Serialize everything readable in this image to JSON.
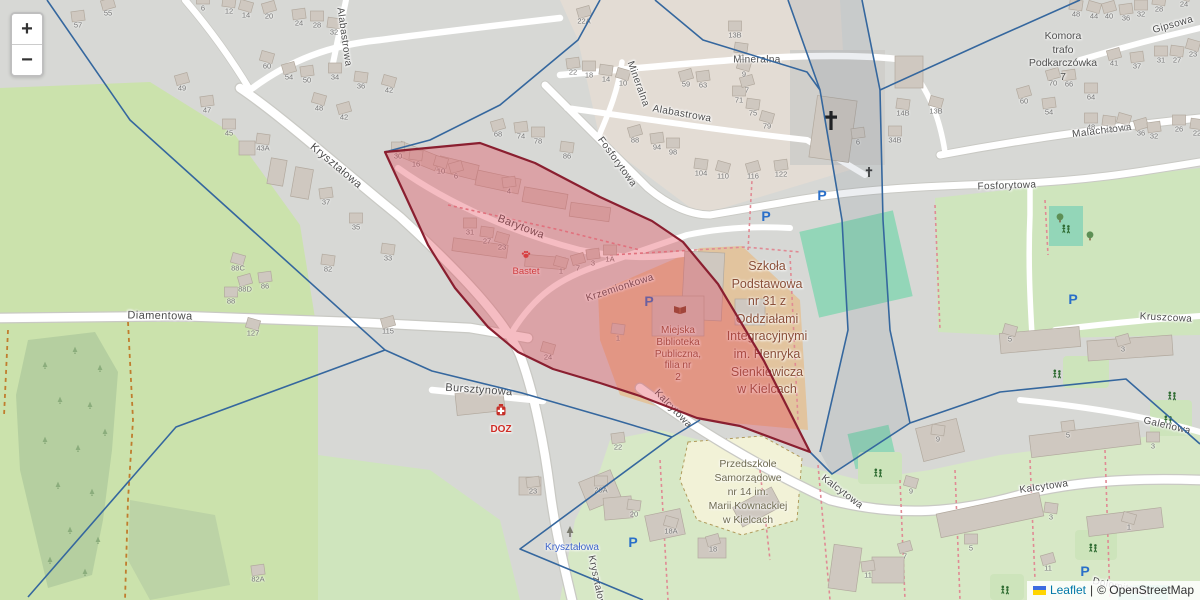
{
  "map": {
    "controls": {
      "zoom_in": "+",
      "zoom_out": "−"
    },
    "attribution": {
      "leaflet": "Leaflet",
      "separator": "|",
      "copyright": "© OpenStreetMap"
    },
    "colors": {
      "selection_fill": "rgba(228,70,86,0.36)",
      "selection_stroke": "#8a1f30",
      "overlay_line": "#35679e",
      "parking_blue": "#2a6fc9",
      "poi_red": "#cc3b35",
      "bus_stop_blue": "#3c63c9",
      "school_label_brown": "#8a4f38"
    }
  },
  "labels": {
    "streets": [
      {
        "text": "Kryształowa",
        "x": 336,
        "y": 166,
        "rot": 40,
        "size": 11
      },
      {
        "text": "Diamentowa",
        "x": 160,
        "y": 316,
        "rot": 1,
        "size": 11
      },
      {
        "text": "Bursztynowa",
        "x": 479,
        "y": 390,
        "rot": 4,
        "size": 11
      },
      {
        "text": "Barytowa",
        "x": 521,
        "y": 227,
        "rot": 21,
        "size": 11
      },
      {
        "text": "Krzemionkowa",
        "x": 620,
        "y": 288,
        "rot": -18,
        "size": 10
      },
      {
        "text": "Kalcytowa",
        "x": 673,
        "y": 409,
        "rot": 46,
        "size": 10
      },
      {
        "text": "Kalcytowa",
        "x": 842,
        "y": 492,
        "rot": 37,
        "size": 10
      },
      {
        "text": "Kalcytowa",
        "x": 1044,
        "y": 487,
        "rot": -8,
        "size": 10
      },
      {
        "text": "Fosforytowa",
        "x": 617,
        "y": 162,
        "rot": 54,
        "size": 10
      },
      {
        "text": "Fosforytowa",
        "x": 1007,
        "y": 186,
        "rot": -2,
        "size": 10
      },
      {
        "text": "Alabastrowa",
        "x": 344,
        "y": 37,
        "rot": 82,
        "size": 10
      },
      {
        "text": "Alabastrowa",
        "x": 682,
        "y": 114,
        "rot": 10,
        "size": 10
      },
      {
        "text": "Mineralna",
        "x": 757,
        "y": 60,
        "rot": 0,
        "size": 10
      },
      {
        "text": "Mineralna",
        "x": 638,
        "y": 84,
        "rot": 70,
        "size": 10
      },
      {
        "text": "Malachitowa",
        "x": 1102,
        "y": 131,
        "rot": -7,
        "size": 10
      },
      {
        "text": "Gipsowa",
        "x": 1173,
        "y": 25,
        "rot": -16,
        "size": 10
      },
      {
        "text": "Kruszcowa",
        "x": 1166,
        "y": 318,
        "rot": 3,
        "size": 10
      },
      {
        "text": "Galenowa",
        "x": 1167,
        "y": 426,
        "rot": 13,
        "size": 10
      },
      {
        "text": "Kryształowa",
        "x": 597,
        "y": 584,
        "rot": 78,
        "size": 10
      },
      {
        "text": "Dolomitowa",
        "x": 1120,
        "y": 587,
        "rot": 12,
        "size": 10
      }
    ],
    "places": [
      {
        "name": "school",
        "x": 767,
        "y": 258,
        "lh": 17.6,
        "size": 12.5,
        "color": "#8a4f38",
        "lines": [
          "Szkoła",
          "Podstawowa",
          "nr 31 z",
          "Oddziałami",
          "Integracyjnymi",
          "im. Henryka",
          "Sienkiewicza",
          "w Kielcach"
        ]
      },
      {
        "name": "library",
        "x": 678,
        "y": 325,
        "lh": 11.8,
        "size": 10,
        "color": "#8a4f38",
        "lines": [
          "Miejska",
          "Biblioteka",
          "Publiczna,",
          "filia nr",
          "2"
        ]
      },
      {
        "name": "kindergarten",
        "x": 748,
        "y": 457,
        "lh": 14,
        "size": 10.5,
        "color": "#6f6b51",
        "lines": [
          "Przedszkole",
          "Samorządowe",
          "nr 14 im.",
          "Marii Kownackiej",
          "w Kielcach"
        ]
      },
      {
        "name": "transformer-station",
        "x": 1063,
        "y": 30,
        "lh": 13.5,
        "size": 10.5,
        "color": "#4f4f4f",
        "lines": [
          "Komora",
          "trafo",
          "Podkarczówka",
          "7"
        ]
      },
      {
        "name": "bastet-pet-shop",
        "x": 526,
        "y": 266,
        "lh": 11,
        "size": 9.5,
        "color": "#c43c35",
        "lines": [
          "Bastet"
        ]
      },
      {
        "name": "doz-pharmacy",
        "x": 501,
        "y": 424,
        "lh": 11,
        "size": 10,
        "color": "#cf2b24",
        "bold": true,
        "lines": [
          "DOZ"
        ]
      },
      {
        "name": "bus-stop-krysztalowa",
        "x": 572,
        "y": 542,
        "lh": 11,
        "size": 10,
        "color": "#3c63c9",
        "lines": [
          "Kryształowa"
        ]
      }
    ],
    "house_numbers": [
      [
        "55",
        108,
        13
      ],
      [
        "57",
        78,
        25
      ],
      [
        "6",
        203,
        8
      ],
      [
        "12",
        229,
        11
      ],
      [
        "14",
        246,
        15
      ],
      [
        "20",
        269,
        16
      ],
      [
        "24",
        299,
        23
      ],
      [
        "28",
        317,
        25
      ],
      [
        "32",
        334,
        32
      ],
      [
        "60",
        267,
        66
      ],
      [
        "54",
        289,
        77
      ],
      [
        "50",
        307,
        80
      ],
      [
        "34",
        335,
        77
      ],
      [
        "36",
        361,
        86
      ],
      [
        "42",
        389,
        90
      ],
      [
        "49",
        182,
        88
      ],
      [
        "47",
        207,
        110
      ],
      [
        "45",
        229,
        133
      ],
      [
        "43A",
        263,
        148
      ],
      [
        "48",
        319,
        108
      ],
      [
        "42",
        344,
        117
      ],
      [
        "37",
        326,
        202
      ],
      [
        "35",
        356,
        227
      ],
      [
        "33",
        388,
        258
      ],
      [
        "88C",
        238,
        268
      ],
      [
        "88D",
        245,
        289
      ],
      [
        "86",
        265,
        286
      ],
      [
        "88",
        231,
        301
      ],
      [
        "82",
        328,
        269
      ],
      [
        "127",
        253,
        333
      ],
      [
        "115",
        388,
        331
      ],
      [
        "82A",
        258,
        579
      ],
      [
        "30",
        398,
        156
      ],
      [
        "16",
        416,
        164
      ],
      [
        "10",
        441,
        171
      ],
      [
        "6",
        456,
        176
      ],
      [
        "4",
        509,
        191
      ],
      [
        "31",
        470,
        232
      ],
      [
        "27",
        487,
        241
      ],
      [
        "23",
        502,
        247
      ],
      [
        "68",
        498,
        134
      ],
      [
        "74",
        521,
        136
      ],
      [
        "78",
        538,
        141
      ],
      [
        "86",
        567,
        156
      ],
      [
        "1",
        561,
        271
      ],
      [
        "7",
        578,
        268
      ],
      [
        "3",
        593,
        263
      ],
      [
        "1A",
        610,
        259
      ],
      [
        "1",
        618,
        338
      ],
      [
        "24",
        548,
        357
      ],
      [
        "22A",
        584,
        21
      ],
      [
        "22",
        573,
        72
      ],
      [
        "18",
        589,
        75
      ],
      [
        "14",
        606,
        79
      ],
      [
        "10",
        623,
        83
      ],
      [
        "59",
        686,
        84
      ],
      [
        "63",
        703,
        85
      ],
      [
        "71",
        739,
        100
      ],
      [
        "75",
        753,
        113
      ],
      [
        "79",
        767,
        126
      ],
      [
        "88",
        635,
        140
      ],
      [
        "94",
        657,
        147
      ],
      [
        "98",
        673,
        152
      ],
      [
        "104",
        701,
        173
      ],
      [
        "110",
        723,
        176
      ],
      [
        "116",
        753,
        176
      ],
      [
        "122",
        781,
        174
      ],
      [
        "13B",
        735,
        35
      ],
      [
        "11",
        741,
        57
      ],
      [
        "9",
        744,
        74
      ],
      [
        "7",
        747,
        90
      ],
      [
        "6",
        858,
        142
      ],
      [
        "34B",
        895,
        140
      ],
      [
        "14B",
        903,
        113
      ],
      [
        "13B",
        936,
        111
      ],
      [
        "70",
        1053,
        83
      ],
      [
        "66",
        1069,
        84
      ],
      [
        "64",
        1091,
        97
      ],
      [
        "48",
        1076,
        14
      ],
      [
        "44",
        1094,
        16
      ],
      [
        "40",
        1109,
        16
      ],
      [
        "36",
        1126,
        18
      ],
      [
        "32",
        1141,
        14
      ],
      [
        "28",
        1159,
        9
      ],
      [
        "24",
        1184,
        4
      ],
      [
        "41",
        1114,
        63
      ],
      [
        "37",
        1137,
        66
      ],
      [
        "31",
        1161,
        60
      ],
      [
        "27",
        1177,
        60
      ],
      [
        "23",
        1193,
        54
      ],
      [
        "60",
        1024,
        101
      ],
      [
        "54",
        1049,
        112
      ],
      [
        "48",
        1091,
        127
      ],
      [
        "44",
        1109,
        130
      ],
      [
        "40",
        1124,
        128
      ],
      [
        "36",
        1141,
        133
      ],
      [
        "32",
        1154,
        136
      ],
      [
        "26",
        1179,
        129
      ],
      [
        "22",
        1197,
        133
      ],
      [
        "5",
        1010,
        339
      ],
      [
        "3",
        1123,
        349
      ],
      [
        "5",
        1068,
        435
      ],
      [
        "3",
        1153,
        446
      ],
      [
        "9",
        938,
        439
      ],
      [
        "9",
        911,
        491
      ],
      [
        "7",
        905,
        556
      ],
      [
        "11",
        868,
        575
      ],
      [
        "5",
        971,
        548
      ],
      [
        "3",
        1051,
        517
      ],
      [
        "1",
        1129,
        527
      ],
      [
        "11",
        1048,
        568
      ],
      [
        "23",
        533,
        491
      ],
      [
        "20A",
        601,
        490
      ],
      [
        "20",
        634,
        514
      ],
      [
        "18A",
        671,
        531
      ],
      [
        "18",
        713,
        549
      ],
      [
        "22",
        618,
        447
      ]
    ]
  },
  "icons": [
    {
      "t": "parking",
      "x": 766,
      "y": 221
    },
    {
      "t": "parking",
      "x": 822,
      "y": 200
    },
    {
      "t": "parking",
      "x": 649,
      "y": 306
    },
    {
      "t": "parking",
      "x": 1073,
      "y": 304
    },
    {
      "t": "parking",
      "x": 633,
      "y": 547
    },
    {
      "t": "parking",
      "x": 1085,
      "y": 576
    },
    {
      "t": "church-cross",
      "x": 831,
      "y": 120
    },
    {
      "t": "wayside-cross",
      "x": 869,
      "y": 172
    },
    {
      "t": "paw",
      "x": 526,
      "y": 254
    },
    {
      "t": "pharmacy",
      "x": 501,
      "y": 411
    },
    {
      "t": "book",
      "x": 680,
      "y": 310
    },
    {
      "t": "tree",
      "x": 1090,
      "y": 236
    },
    {
      "t": "tree",
      "x": 1060,
      "y": 218
    },
    {
      "t": "playground",
      "x": 1066,
      "y": 228
    },
    {
      "t": "playground",
      "x": 1057,
      "y": 373
    },
    {
      "t": "playground",
      "x": 1172,
      "y": 395
    },
    {
      "t": "playground",
      "x": 878,
      "y": 472
    },
    {
      "t": "playground",
      "x": 1093,
      "y": 547
    },
    {
      "t": "playground",
      "x": 1005,
      "y": 589
    },
    {
      "t": "playground",
      "x": 1168,
      "y": 419
    },
    {
      "t": "dark-tree",
      "x": 570,
      "y": 532
    },
    {
      "t": "forest-tree",
      "x": 45,
      "y": 365
    },
    {
      "t": "forest-tree",
      "x": 75,
      "y": 350
    },
    {
      "t": "forest-tree",
      "x": 100,
      "y": 368
    },
    {
      "t": "forest-tree",
      "x": 60,
      "y": 400
    },
    {
      "t": "forest-tree",
      "x": 90,
      "y": 405
    },
    {
      "t": "forest-tree",
      "x": 45,
      "y": 440
    },
    {
      "t": "forest-tree",
      "x": 78,
      "y": 448
    },
    {
      "t": "forest-tree",
      "x": 105,
      "y": 432
    },
    {
      "t": "forest-tree",
      "x": 58,
      "y": 485
    },
    {
      "t": "forest-tree",
      "x": 92,
      "y": 492
    },
    {
      "t": "forest-tree",
      "x": 70,
      "y": 530
    },
    {
      "t": "forest-tree",
      "x": 98,
      "y": 540
    },
    {
      "t": "forest-tree",
      "x": 50,
      "y": 560
    },
    {
      "t": "forest-tree",
      "x": 85,
      "y": 572
    }
  ]
}
